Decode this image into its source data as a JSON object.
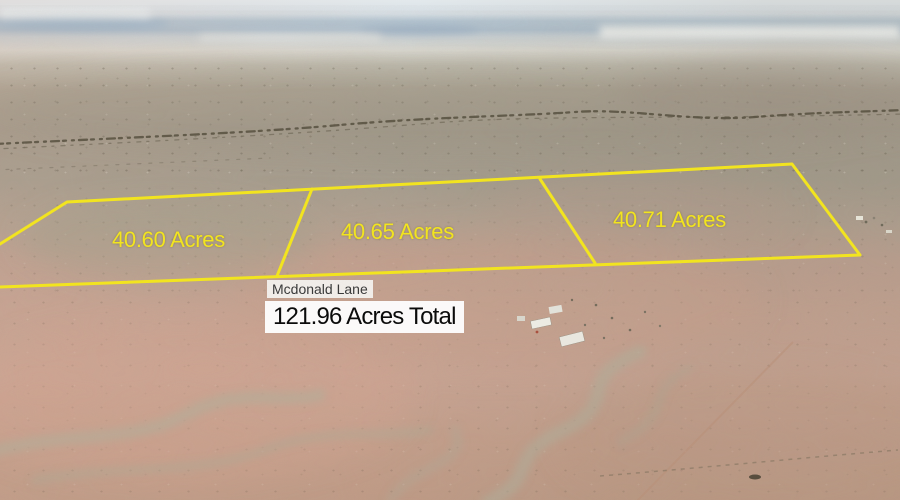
{
  "title": "Aerial land-listing photo with parcel boundary overlay",
  "scene": {
    "description": "Oblique drone photo of flat high-desert scrubland; hazy pale-blue horizon, gray-green scrub flats fading to pink-tan desert, dry washes lower left, small homestead buildings center right",
    "sky_color": "#b6c8d6",
    "haze_color": "#dddcd5",
    "scrub_color": "#a49c8e",
    "desert_pink_color": "#cda695",
    "wash_color": "#b2ad9a"
  },
  "overlay": {
    "boundary_color": "#f2e41f",
    "label_color": "#f2e41f",
    "parcels": [
      {
        "label": "40.60 Acres"
      },
      {
        "label": "40.65 Acres"
      },
      {
        "label": "40.71 Acres"
      }
    ],
    "road_label": "Mcdonald Lane",
    "road_label_style": {
      "text_color": "#3a3a3a",
      "background": "#f7f7f5"
    },
    "total_label": "121.96 Acres Total",
    "total_label_style": {
      "text_color": "#0b0b0b",
      "background": "#fdfdfd"
    },
    "paths": {
      "outer": "M 0,244 L 67,202 L 792,164 L 860,255 L 0,287",
      "divider1": "M 312,189 L 277,276",
      "divider2": "M 540,179 L 595,263"
    }
  }
}
